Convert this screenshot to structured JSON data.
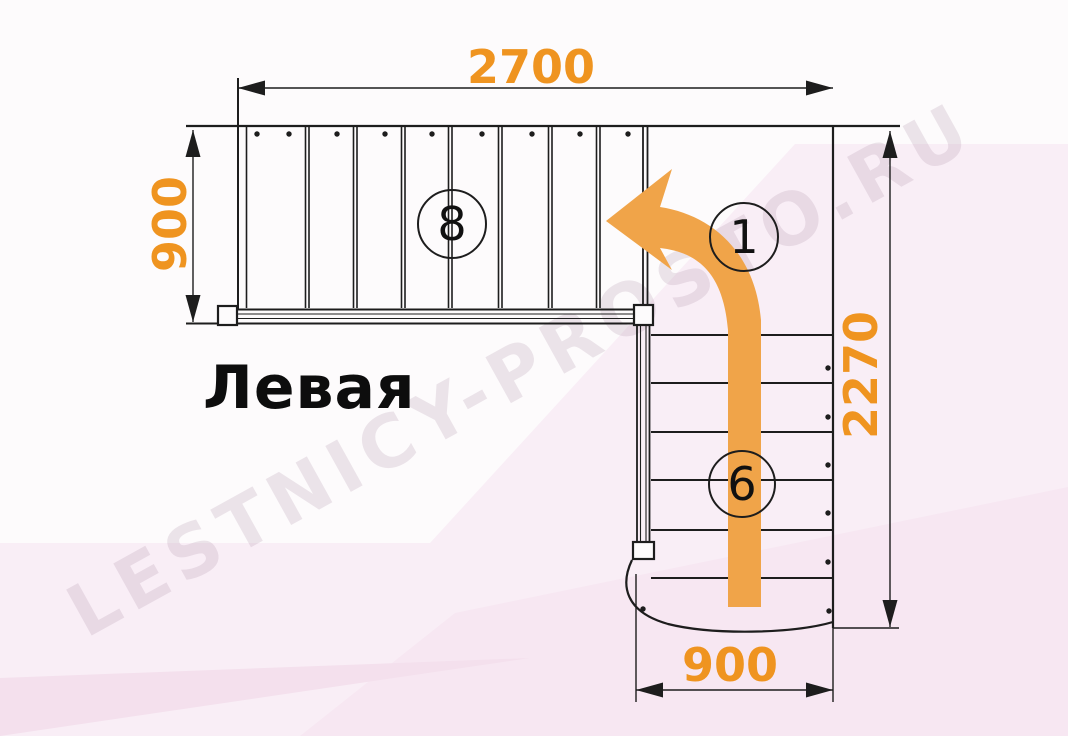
{
  "watermark_text": "LESTNICY-PROSTO.RU",
  "title_label": "Левая",
  "dimensions": {
    "top": "2700",
    "left": "900",
    "right": "2270",
    "bottom": "900"
  },
  "markers": {
    "upper_flight_steps": "8",
    "turn_start": "1",
    "lower_flight_steps": "6"
  },
  "colors": {
    "dimension_text": "#ef9420",
    "arrow": "#f0a449",
    "line": "#1d1d1d",
    "bg_pink_1": "#f9eef6",
    "bg_pink_2": "#f7e7f2",
    "bg_pink_3": "#f4e0ed"
  }
}
